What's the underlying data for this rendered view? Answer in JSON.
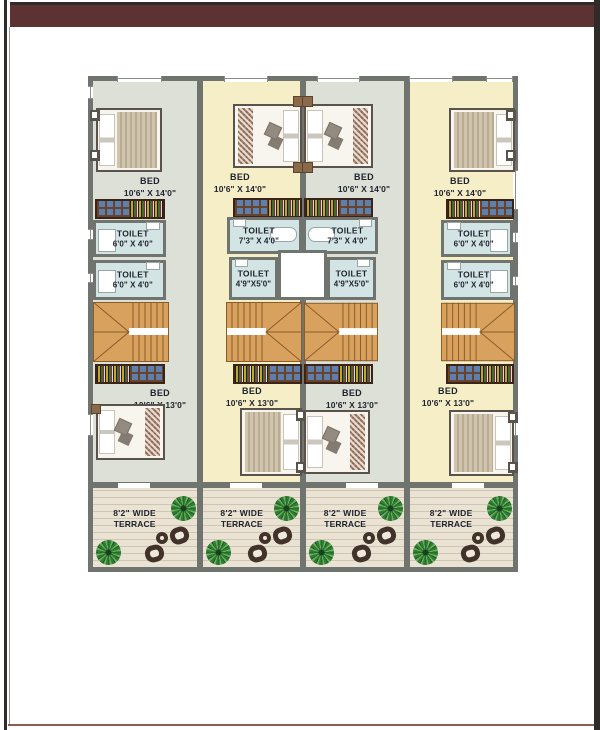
{
  "colors": {
    "bar": "#5d3233",
    "frame_dark": "#2f2b28",
    "bottom_line": "#8a5f4f",
    "wall": "#70746f",
    "floor_gray": "#dce0d6",
    "floor_yellow": "#f6eec7",
    "floor_toilet": "#d3e4e4",
    "floor_terrace": "#eae3d3",
    "stair": "#d8a25e",
    "ink": "#20242f"
  },
  "units": [
    {
      "bed_top": {
        "label": "BED",
        "dims": "10'6\" X 14'0\""
      },
      "toilet_1": {
        "label": "TOILET",
        "dims": "6'0\" X 4'0\""
      },
      "toilet_2": {
        "label": "TOILET",
        "dims": "6'0\" X 4'0\""
      },
      "bed_bottom": {
        "label": "BED",
        "dims": "10'6\" X 13'0\""
      },
      "terrace": {
        "line1": "8'2\" WIDE",
        "line2": "TERRACE"
      }
    },
    {
      "bed_top": {
        "label": "BED",
        "dims": "10'6\" X 14'0\""
      },
      "toilet_1": {
        "label": "TOILET",
        "dims": "7'3\" X 4'0\""
      },
      "toilet_2": {
        "label": "TOILET",
        "dims": "4'9\"X5'0\""
      },
      "bed_bottom": {
        "label": "BED",
        "dims": "10'6\" X 13'0\""
      },
      "terrace": {
        "line1": "8'2\" WIDE",
        "line2": "TERRACE"
      }
    },
    {
      "bed_top": {
        "label": "BED",
        "dims": "10'6\" X 14'0\""
      },
      "toilet_1": {
        "label": "TOILET",
        "dims": "7'3\" X 4'0\""
      },
      "toilet_2": {
        "label": "TOILET",
        "dims": "4'9\"X5'0\""
      },
      "bed_bottom": {
        "label": "BED",
        "dims": "10'6\" X 13'0\""
      },
      "terrace": {
        "line1": "8'2\" WIDE",
        "line2": "TERRACE"
      }
    },
    {
      "bed_top": {
        "label": "BED",
        "dims": "10'6\" X 14'0\""
      },
      "toilet_1": {
        "label": "TOILET",
        "dims": "6'0\" X 4'0\""
      },
      "toilet_2": {
        "label": "TOILET",
        "dims": "6'0\" X 4'0\""
      },
      "bed_bottom": {
        "label": "BED",
        "dims": "10'6\" X 13'0\""
      },
      "terrace": {
        "line1": "8'2\" WIDE",
        "line2": "TERRACE"
      }
    }
  ]
}
